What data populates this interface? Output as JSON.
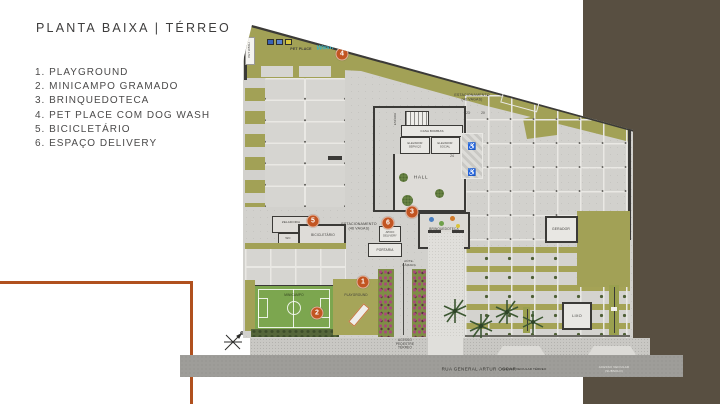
{
  "slide": {
    "title": "PLANTA BAIXA | TÉRREO"
  },
  "legend": {
    "items": [
      {
        "num": "1.",
        "label": "PLAYGROUND"
      },
      {
        "num": "2.",
        "label": "MINICAMPO GRAMADO"
      },
      {
        "num": "3.",
        "label": "BRINQUEDOTECA"
      },
      {
        "num": "4.",
        "label": "PET PLACE COM DOG WASH"
      },
      {
        "num": "5.",
        "label": "BICICLETÁRIO"
      },
      {
        "num": "6.",
        "label": "ESPAÇO DELIVERY"
      }
    ]
  },
  "plan": {
    "markers": [
      {
        "num": "1"
      },
      {
        "num": "2"
      },
      {
        "num": "3"
      },
      {
        "num": "4"
      },
      {
        "num": "5"
      },
      {
        "num": "6"
      }
    ],
    "labels": {
      "estacionamento": "ESTACIONAMENTO\n(46 VAGAS)",
      "hall": "HALL",
      "escada": "ESCADA",
      "casa_bombas": "CASA BOMBAS",
      "elevador_servico": "ELEVADOR\nSERVIÇO",
      "elevador_social": "ELEVADOR\nSOCIAL",
      "zeladoria": "ZELADORIA",
      "wc": "WC",
      "bicicletario": "BICICLETÁRIO",
      "brinquedoteca": "BRINQUEDOTECA",
      "apoio_delivery": "APOIO\nDELIVERY",
      "portaria": "PORTARIA",
      "ante_camara": "ANTE-\nCÂMARA",
      "gerador": "GERADOR",
      "lixo": "LIXO",
      "minicampo": "MINICAMPO",
      "playground": "PLAYGROUND",
      "pet_place": "PET PLACE",
      "pet_wash": "PET WASH",
      "wash_script": "Wash"
    },
    "stalls": {
      "n19": "19",
      "n20": "20",
      "n23": "23",
      "n24": "24"
    },
    "icons": {
      "wheelchair": "♿"
    }
  },
  "street": {
    "name": "RUA GENERAL ARTUR OSCAR",
    "acesso_pedestre": "ACESSO\nPEDESTRE\nTÉRREO",
    "acesso_veicular_terreo": "ACESSO VEICULAR TÉRREO",
    "acesso_veicular_subsolo": "ACESSO VEICULAR (SUBSOLO)"
  },
  "colors": {
    "accent_orange": "#b0501e",
    "marker_orange": "#c25522",
    "olive_green": "#a2a156",
    "field_green": "#7ca64f",
    "brown_band": "#584f41",
    "concrete": "#d2d1cd"
  }
}
